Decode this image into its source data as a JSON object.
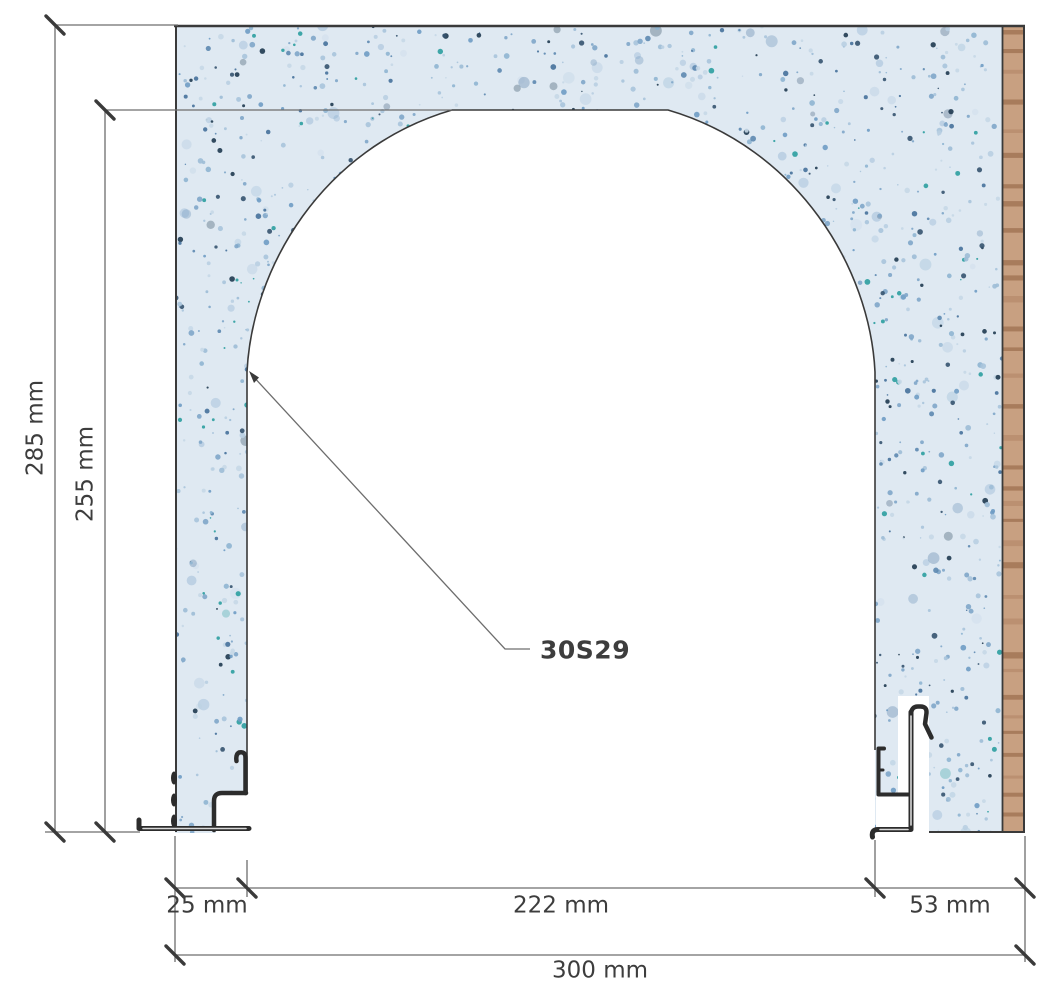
{
  "drawing": {
    "part_label": "30S29",
    "dimensions": {
      "overall_height": "285 mm",
      "opening_height": "255 mm",
      "left_jamb_width": "25 mm",
      "opening_width": "222 mm",
      "right_jamb_width": "53 mm",
      "overall_width": "300 mm"
    },
    "colors": {
      "background": "#ffffff",
      "dim_line": "#6d6d6d",
      "tick": "#3a3a3a",
      "label_text": "#3d3d3d",
      "block_outline": "#3a3a3a",
      "profile_stroke": "#2c2c2c",
      "texture_base": "#dfe9f2",
      "wood_base": "#c8a081",
      "wood_stripe_dark": "#a87c5c",
      "wood_stripe_mid": "#bb9071"
    },
    "texture_speckles": [
      "#a9c4dc",
      "#7fa6c9",
      "#8fb5d2",
      "#5d88b0",
      "#c6d8e7",
      "#46719b",
      "#9dbcd6",
      "#6f9cc4",
      "#35536f",
      "#b9cfe2",
      "#2c9fa0",
      "#1f3a50",
      "#7fa6c9",
      "#a9c4dc",
      "#c6d8e7"
    ]
  }
}
